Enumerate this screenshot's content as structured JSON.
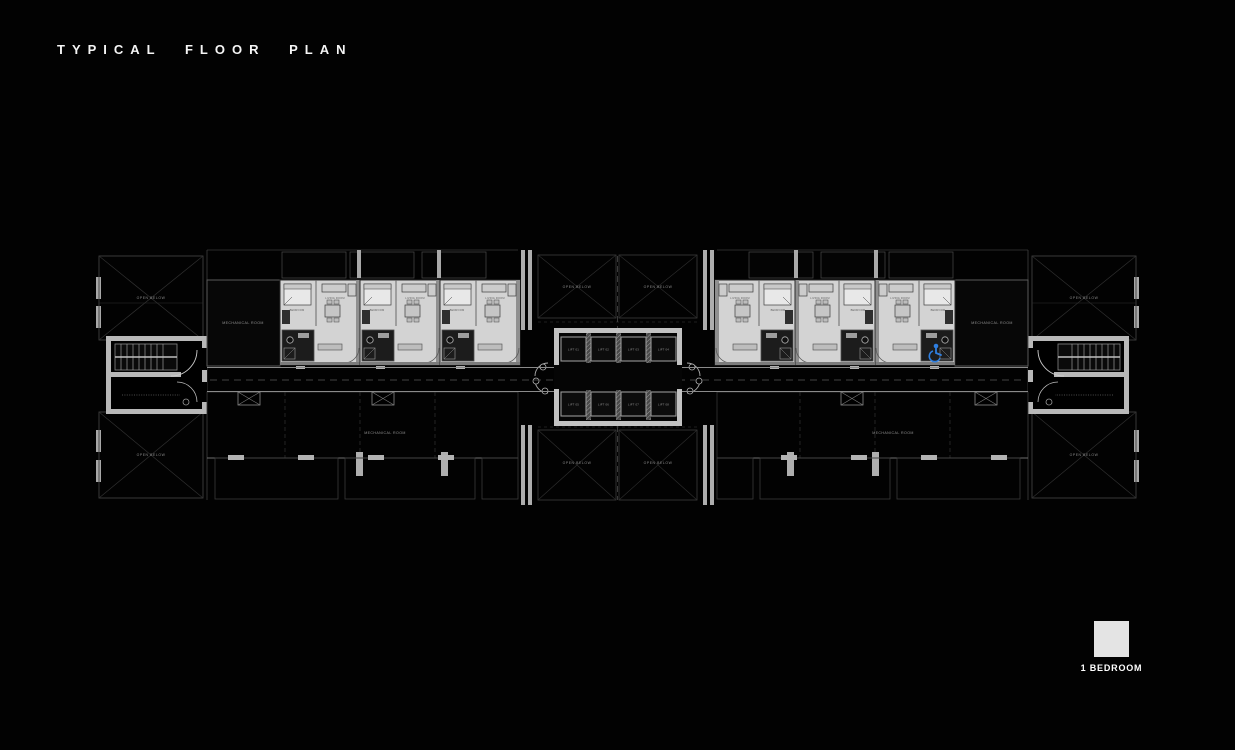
{
  "header": {
    "title": "TYPICAL FLOOR PLAN"
  },
  "legend": {
    "label": "1 BEDROOM",
    "swatch_color": "#e4e4e4"
  },
  "plan": {
    "open_below_labels": [
      "OPEN BELOW",
      "OPEN BELOW",
      "OPEN BELOW",
      "OPEN BELOW",
      "OPEN BELOW",
      "OPEN BELOW",
      "OPEN BELOW",
      "OPEN BELOW"
    ],
    "mechanical_rooms": [
      "MECHANICAL ROOM",
      "MECHANICAL ROOM",
      "MECHANICAL ROOM",
      "MECHANICAL ROOM"
    ],
    "lifts": [
      {
        "label": "LIFT 01"
      },
      {
        "label": "LIFT 02"
      },
      {
        "label": "LIFT 03"
      },
      {
        "label": "LIFT 04"
      },
      {
        "label": "LIFT 05"
      },
      {
        "label": "LIFT 06"
      },
      {
        "label": "LIFT 07"
      },
      {
        "label": "LIFT 08"
      }
    ],
    "unit": {
      "bedroom_label": "BEDROOM",
      "living_label": "LIVING ROOM"
    },
    "colors": {
      "background": "#000000",
      "unit_fill": "#d3d3d3",
      "wall_light": "#c2c2c2",
      "line_dim": "#3f3f3f",
      "label_dim": "#8f8f8f",
      "accessible_blue": "#2f7fe0"
    }
  }
}
